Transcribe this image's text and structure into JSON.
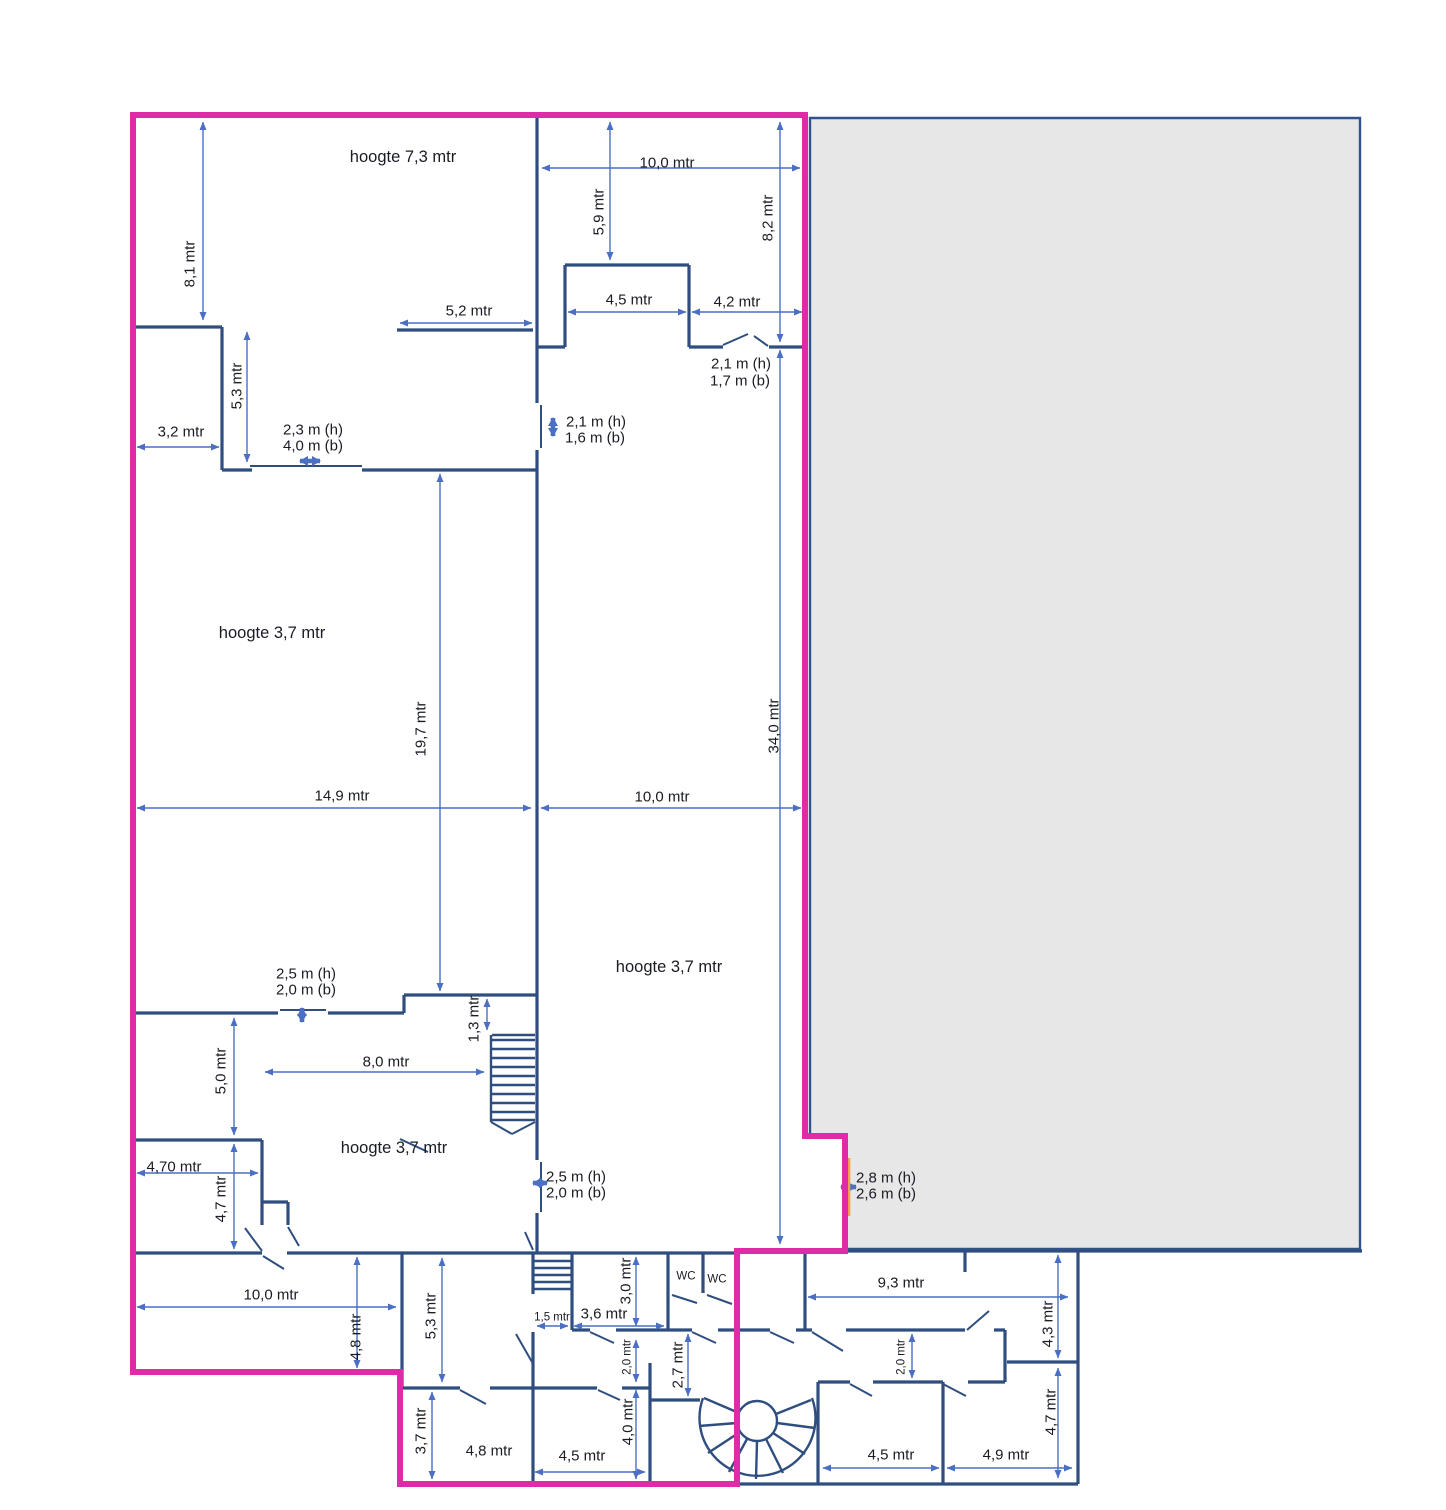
{
  "colors": {
    "outline": "#e02ba8",
    "wall": "#2f4e7f",
    "dim": "#4a6fc3",
    "gray_fill": "#e7e7e8",
    "gray_border": "#31538c",
    "door_accent": "#f0a04a",
    "text": "#191c24"
  },
  "labels": {
    "hoogte73": "hoogte 7,3 mtr",
    "d81": "8,1 mtr",
    "d100t": "10,0 mtr",
    "d59": "5,9 mtr",
    "d82": "8,2 mtr",
    "d52": "5,2 mtr",
    "d45t": "4,5 mtr",
    "d42": "4,2 mtr",
    "door17h": "2,1 m (h)",
    "door17b": "1,7 m (b)",
    "door16h": "2,1 m (h)",
    "door16b": "1,6 m (b)",
    "d32": "3,2 mtr",
    "d53a": "5,3 mtr",
    "door40h": "2,3 m (h)",
    "door40b": "4,0 m (b)",
    "hoogte37a": "hoogte 3,7 mtr",
    "d197": "19,7 mtr",
    "d149": "14,9 mtr",
    "d100m": "10,0 mtr",
    "d340": "34,0 mtr",
    "hoogte37b": "hoogte 3,7 mtr",
    "door20ah": "2,5 m (h)",
    "door20ab": "2,0 m (b)",
    "d50": "5,0 mtr",
    "d80": "8,0 mtr",
    "d13": "1,3 mtr",
    "hoogte37c": "hoogte 3,7 mtr",
    "d470": "4,70 mtr",
    "d47a": "4,7 mtr",
    "door20bh": "2,5 m (h)",
    "door20bb": "2,0 m (b)",
    "door26h": "2,8 m (h)",
    "door26b": "2,6 m (b)",
    "wc1": "WC",
    "wc2": "WC",
    "d30": "3,0 mtr",
    "d93": "9,3 mtr",
    "d15": "1,5 mtr",
    "d36": "3,6 mtr",
    "d53b": "5,3 mtr",
    "d48a": "4,8 mtr",
    "d100b": "10,0 mtr",
    "d20a": "2,0 mtr",
    "d27": "2,7 mtr",
    "d40": "4,0 mtr",
    "d48b": "4,8 mtr",
    "d45b": "4,5 mtr",
    "d37": "3,7 mtr",
    "d45c": "4,5 mtr",
    "d49": "4,9 mtr",
    "d43": "4,3 mtr",
    "d20b": "2,0 mtr",
    "d47b": "4,7 mtr"
  }
}
